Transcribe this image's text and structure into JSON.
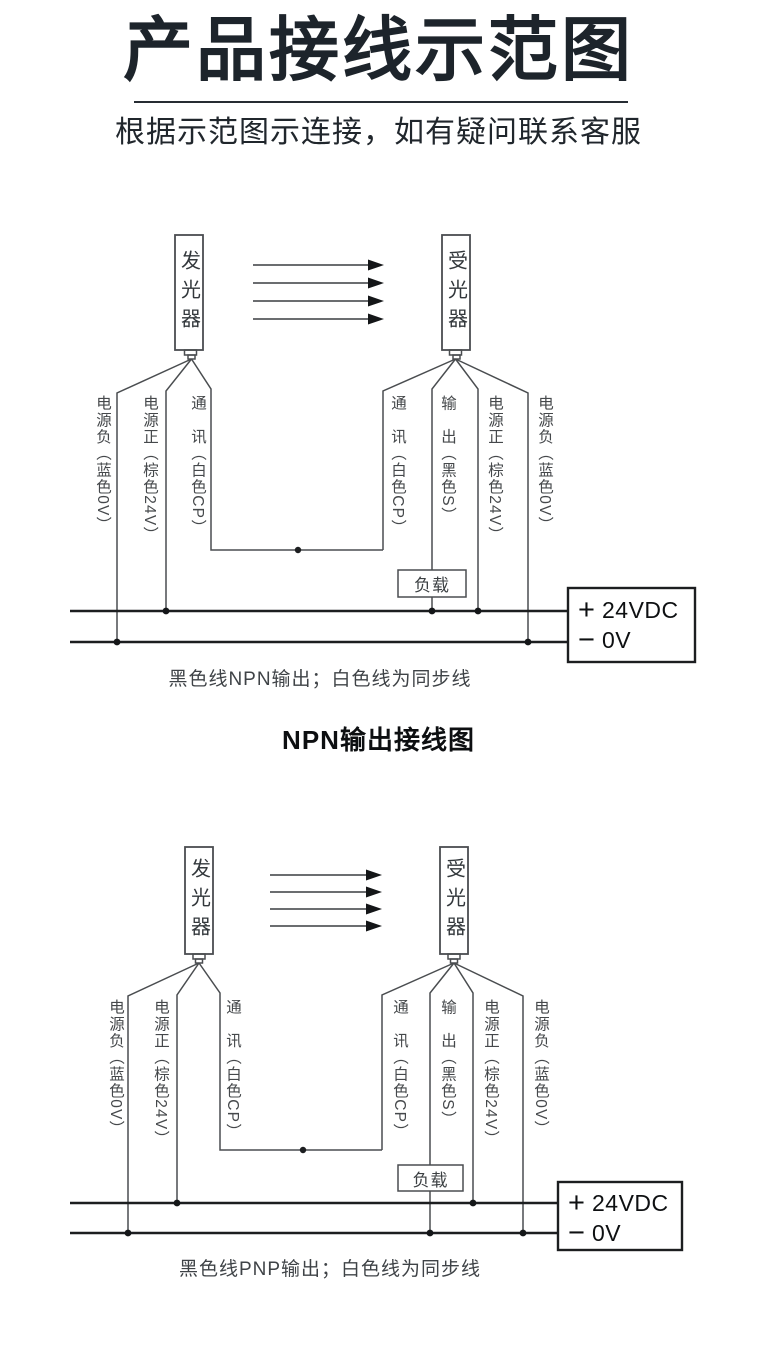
{
  "page": {
    "title": "产品接线示范图",
    "subtitle": "根据示范图示连接，如有疑问联系客服"
  },
  "device": {
    "emitter": "发光器",
    "receiver": "受光器"
  },
  "wires": {
    "power_negative": "电源负（蓝色0V）",
    "power_positive": "电源正（棕色24V）",
    "comm": "通　讯（白色CP）",
    "output": "输　出（黑色S）"
  },
  "load_label": "负载",
  "psu": {
    "plus_sign": "+",
    "plus_value": "24VDC",
    "minus_sign": "−",
    "minus_value": "0V"
  },
  "npn": {
    "caption": "黑色线NPN输出；白色线为同步线",
    "title": "NPN输出接线图"
  },
  "pnp": {
    "caption": "黑色线PNP输出；白色线为同步线"
  },
  "colors": {
    "thin_line": "#4a4d50",
    "bus_line": "#1c1e20",
    "title_text": "#1d242b"
  }
}
